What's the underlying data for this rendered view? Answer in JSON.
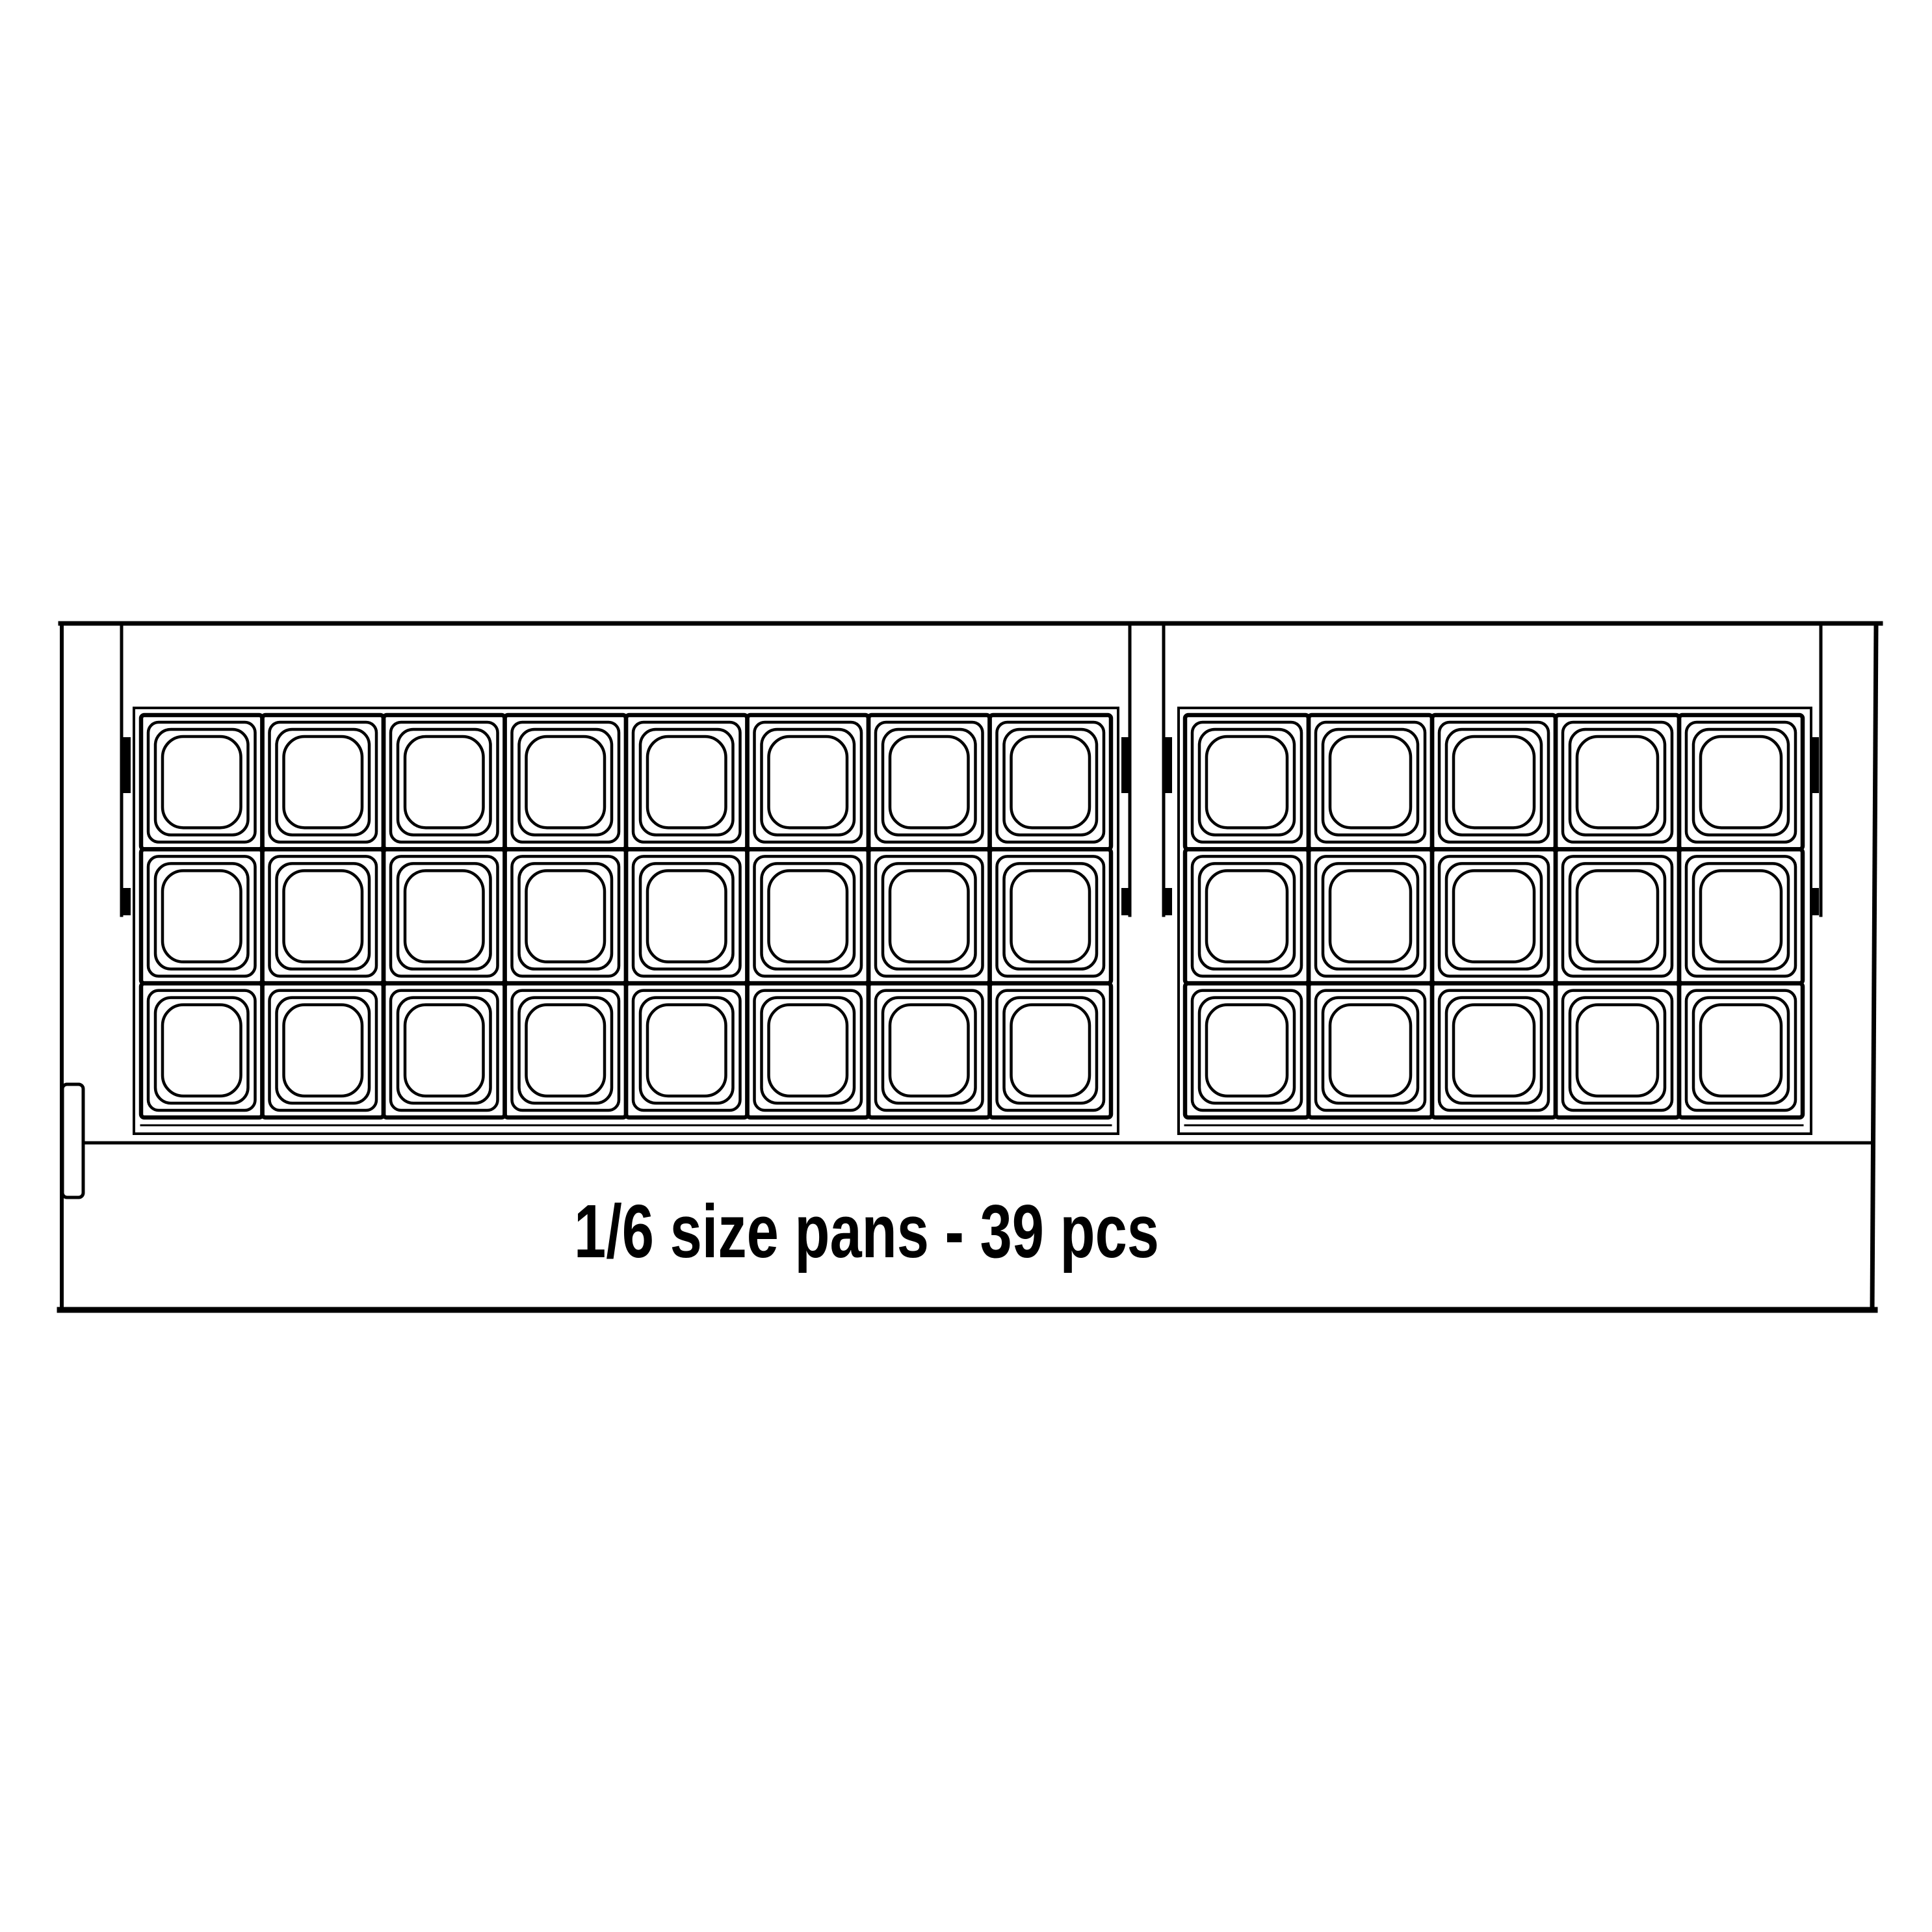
{
  "diagram": {
    "title": "pan layout plan view",
    "caption": "1/6 size pans - 39 pcs",
    "pan_size": "1/6",
    "total_pans": 39,
    "units": "pcs",
    "colors": {
      "line": "#000000",
      "background": "#ffffff"
    },
    "groups": [
      {
        "name": "left-pan-group",
        "rows": 3,
        "cols": 8,
        "pans": 24
      },
      {
        "name": "right-pan-group",
        "rows": 3,
        "cols": 5,
        "pans": 15
      }
    ]
  }
}
